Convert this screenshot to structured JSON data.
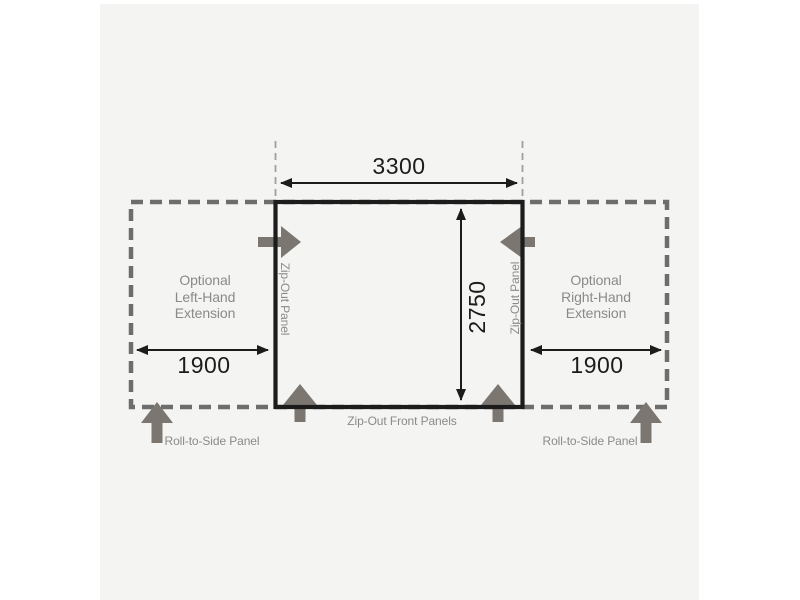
{
  "colors": {
    "page_bg": "#ffffff",
    "panel_bg": "#f4f4f3",
    "line_black": "#1c1c1c",
    "dashed_outline": "#6d6d6d",
    "thin_guide_dash": "#9f9f9f",
    "muted_text": "#8a8a8a",
    "block_arrow": "#7c7670"
  },
  "diagram": {
    "width_label": "3300",
    "depth_label": "2750",
    "left_extension": {
      "line1": "Optional",
      "line2": "Left-Hand",
      "line3": "Extension",
      "width_label": "1900",
      "roll_label": "Roll-to-Side Panel"
    },
    "right_extension": {
      "line1": "Optional",
      "line2": "Right-Hand",
      "line3": "Extension",
      "width_label": "1900",
      "roll_label": "Roll-to-Side Panel"
    },
    "left_side_panel_label": "Zip-Out Panel",
    "right_side_panel_label": "Zip-Out Panel",
    "front_panels_label": "Zip-Out Front Panels"
  }
}
